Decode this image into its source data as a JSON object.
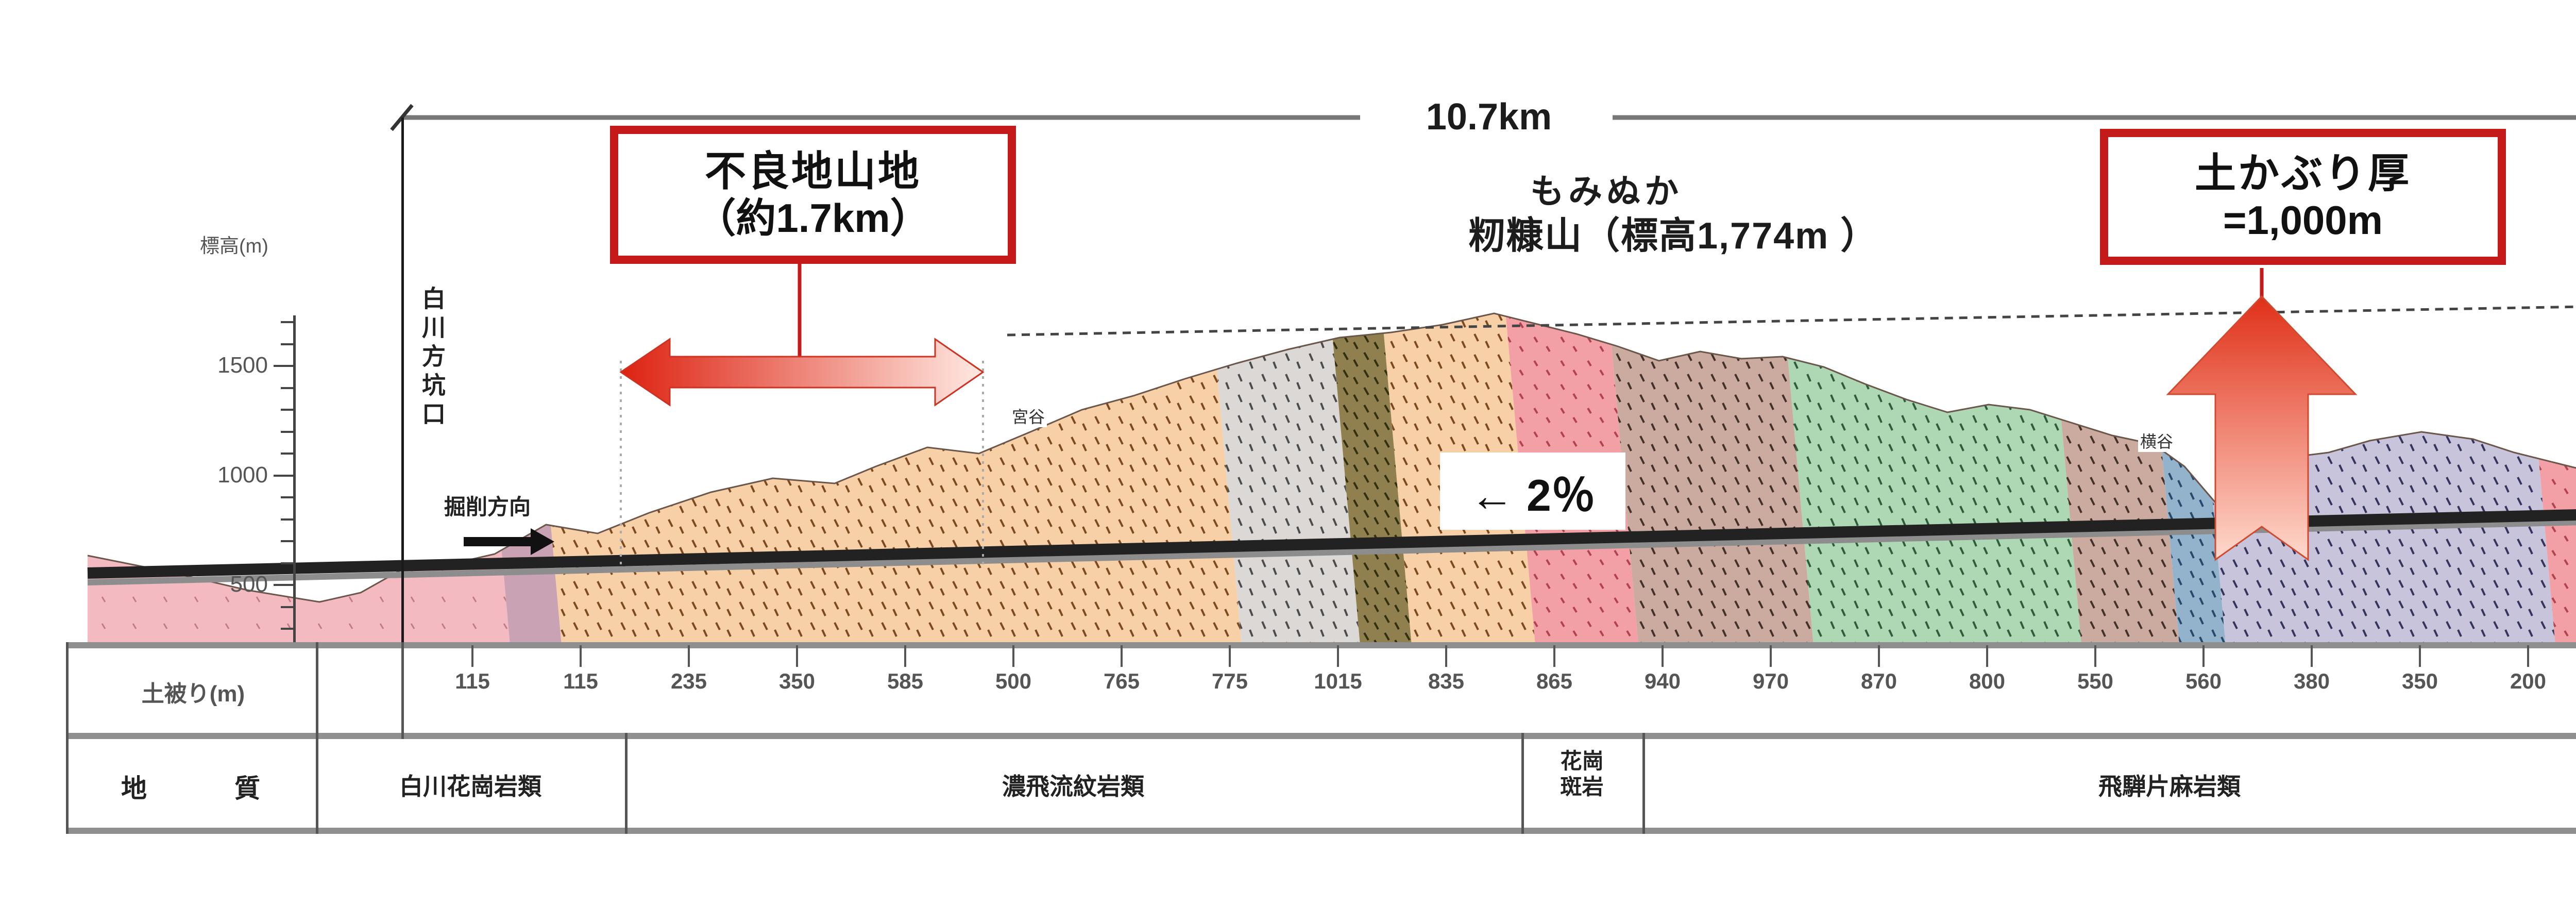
{
  "title": "トンネル地質縦断図",
  "scale_bar": {
    "total_length": "10.7km"
  },
  "portals": {
    "left": "白川方坑口",
    "right": "河合方坑口"
  },
  "axis": {
    "label": "標高(m)",
    "ticks": [
      "1500",
      "1000",
      "500"
    ]
  },
  "annotations": {
    "bad_ground": {
      "line1": "不良地山地",
      "line2": "（約1.7km）"
    },
    "overburden": {
      "line1": "土かぶり厚",
      "line2": "=1,000m"
    },
    "mountain": {
      "furigana": "もみぬか",
      "name": "籾糠山（標高1,774m ）"
    },
    "gradient": "← 2％",
    "excavation_direction": "掘削方向",
    "valley_left": "宮谷",
    "valley_right": "横谷"
  },
  "table": {
    "row1_header": "土被り(m)",
    "row2_header_chars": [
      "地",
      "質"
    ],
    "cover_values": [
      "115",
      "115",
      "235",
      "350",
      "585",
      "500",
      "765",
      "775",
      "1015",
      "835",
      "865",
      "940",
      "970",
      "870",
      "800",
      "550",
      "560",
      "380",
      "350",
      "200",
      "110"
    ],
    "geology": [
      {
        "name": "白川花崗岩類"
      },
      {
        "name": "濃飛流紋岩類"
      },
      {
        "name": "花崗斑岩",
        "line1": "花崗",
        "line2": "斑岩"
      },
      {
        "name": "飛騨片麻岩類"
      },
      {
        "name": "未固結堆積物"
      }
    ]
  },
  "colors": {
    "accent_red": "#c51a1a",
    "dimension_line": "#777777",
    "tunnel_dark": "#222222",
    "tunnel_light": "#8d8d8d",
    "palette": {
      "shirakawa_granite_pink": "#f3bac2",
      "nohi_rhyolite_orange": "#f7d0a8",
      "gray_tuff": "#dcd8d6",
      "olive_band": "#90804f",
      "granite_porphyry_pink": "#f39fa6",
      "gneiss_mauve": "#cbab9f",
      "gneiss_green": "#aed7b4",
      "gneiss_blue": "#93b3cd",
      "gneiss_lavender": "#c8c4dc"
    }
  }
}
